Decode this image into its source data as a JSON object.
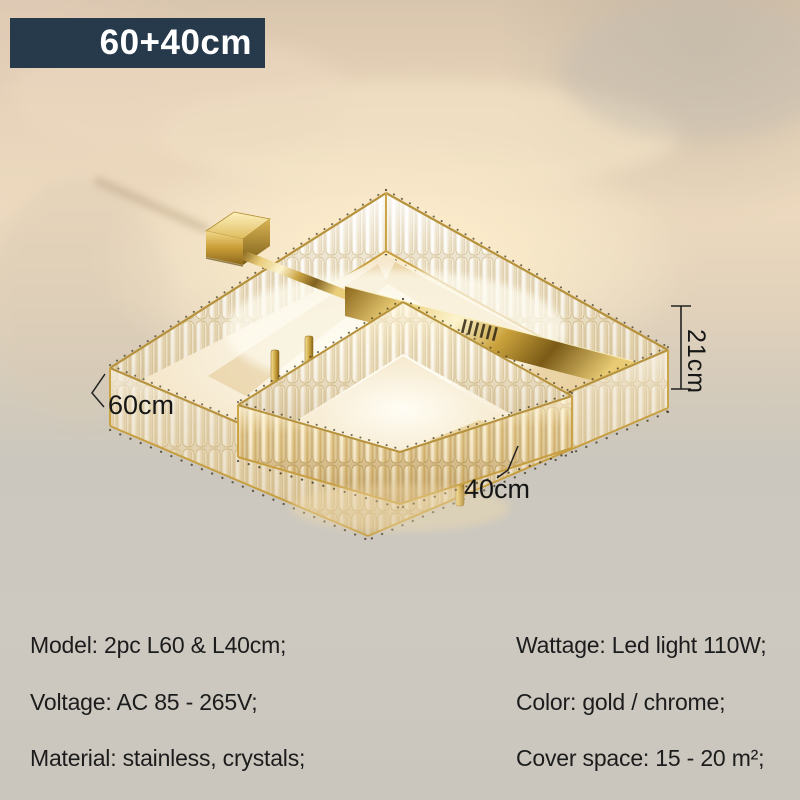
{
  "badge": {
    "label": "60+40cm"
  },
  "dimensions": {
    "height": "21cm",
    "outer_width": "60cm",
    "inner_width": "40cm"
  },
  "specs": {
    "left": [
      "Model: 2pc L60 & L40cm;",
      "Voltage: AC 85 - 265V;",
      "Material: stainless, crystals;"
    ],
    "right": [
      "Wattage: Led light 110W;",
      "Color: gold / chrome;",
      "Cover space: 15 - 20 m²;"
    ]
  },
  "colors": {
    "badge_bg": "#273a4c",
    "badge_text": "#ffffff",
    "gold": "#c9a23e",
    "crystal": "#f2ead8",
    "ceiling_warm": "#ecd9be",
    "background_gray": "#cbc7be",
    "spec_text": "#1c1c1c",
    "dimension_text": "#161616"
  }
}
